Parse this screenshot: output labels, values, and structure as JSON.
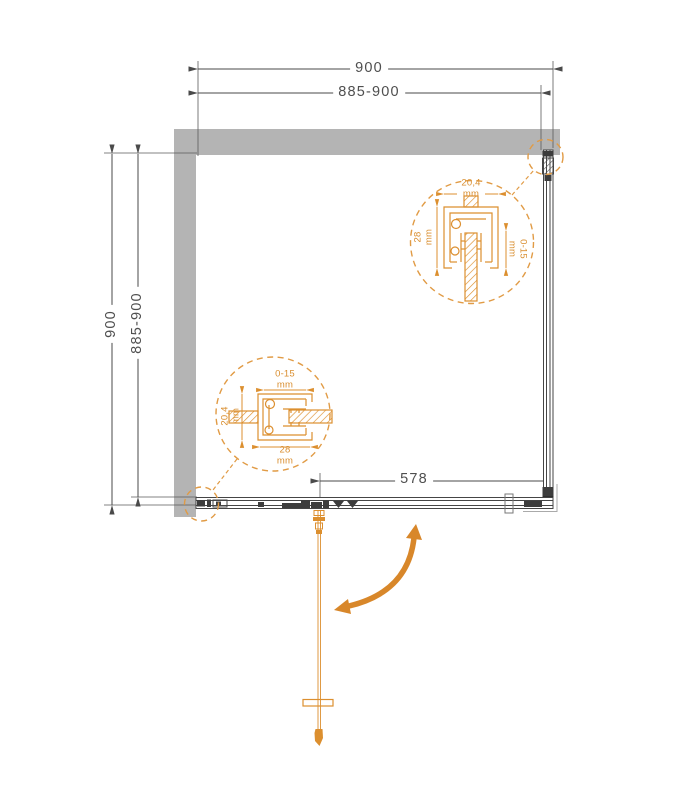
{
  "drawing": {
    "kind": "shower-enclosure-plan-view",
    "dimensions": {
      "top_outer": {
        "value": "900"
      },
      "top_inner": {
        "value": "885-900"
      },
      "left_outer": {
        "value": "900"
      },
      "left_inner": {
        "value": "885-900"
      },
      "door_opening": {
        "value": "578"
      }
    },
    "detail_top_right": {
      "profile_width": {
        "value": "20,4",
        "unit": "mm"
      },
      "profile_depth": {
        "value": "28",
        "unit": "mm"
      },
      "adjustment": {
        "value": "0-15",
        "unit": "mm"
      }
    },
    "detail_bottom_left": {
      "adjustment": {
        "value": "0-15",
        "unit": "mm"
      },
      "profile_width": {
        "value": "20,4",
        "unit": "mm"
      },
      "profile_depth": {
        "value": "28",
        "unit": "mm"
      }
    },
    "colors": {
      "accent_orange": "#dc8f2f",
      "arrow_orange": "#d8872a",
      "wall_gray": "#b4b4b4",
      "line_dark": "#454545",
      "text_gray": "#4f4f4f"
    }
  }
}
